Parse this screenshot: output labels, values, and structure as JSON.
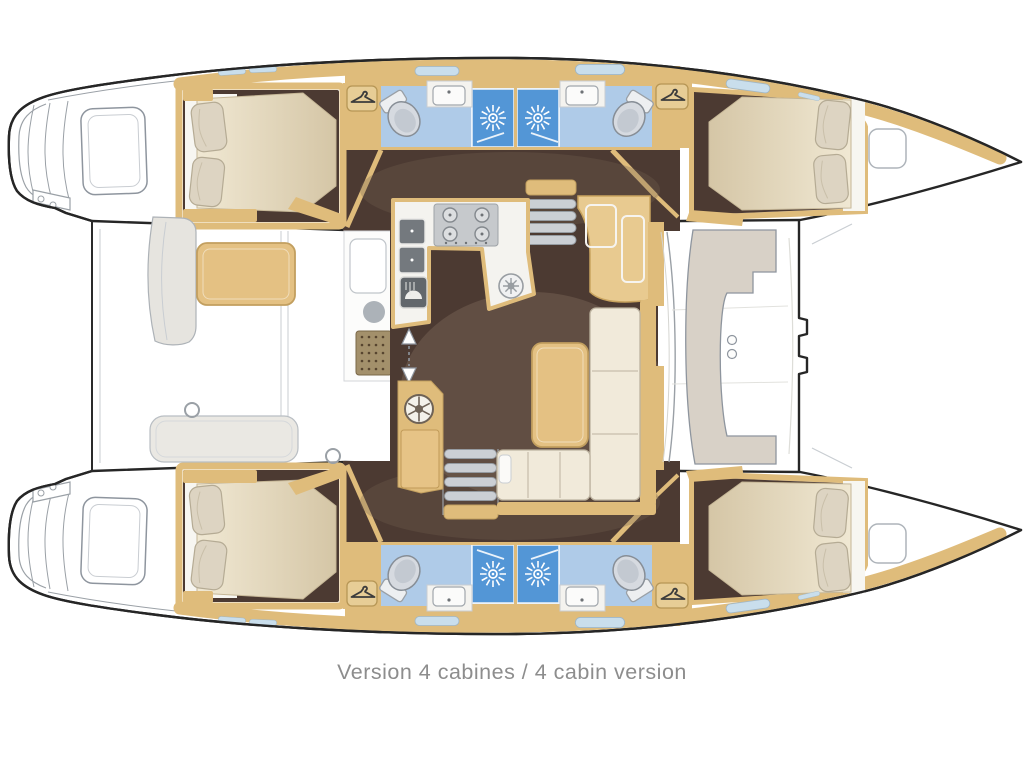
{
  "caption": "Version 4 cabines / 4 cabin version",
  "colors": {
    "outline": "#262626",
    "line": "#9AA0A6",
    "wood": "#DFBC7B",
    "wood_dark": "#C29F5F",
    "floor": "#4C3A32",
    "floor_light": "#756254",
    "bath": "#AFCBE8",
    "shower": "#5396D6",
    "fixture": "#D6DAE0",
    "mattress_light": "#F0E8D3",
    "mattress_dark": "#D5C6A6",
    "pillow": "#DDD4C2",
    "sofa": "#F1EADA",
    "table": "#E4C183",
    "bench": "#E6E4DF",
    "seat": "#D8D1C7",
    "window": "#C9DEEC",
    "caption_color": "#8D8D8D"
  },
  "features": {
    "cabins": 4,
    "bathrooms": 4,
    "showers": 4,
    "wardrobes": 4,
    "galley": "L-shaped galley with double sink, 4-burner stove and oven",
    "salon": "L-shaped sofa, table and chart desk",
    "aft_cockpit": "table with benches",
    "forward_cockpit": "C-shaped lounge seat"
  }
}
